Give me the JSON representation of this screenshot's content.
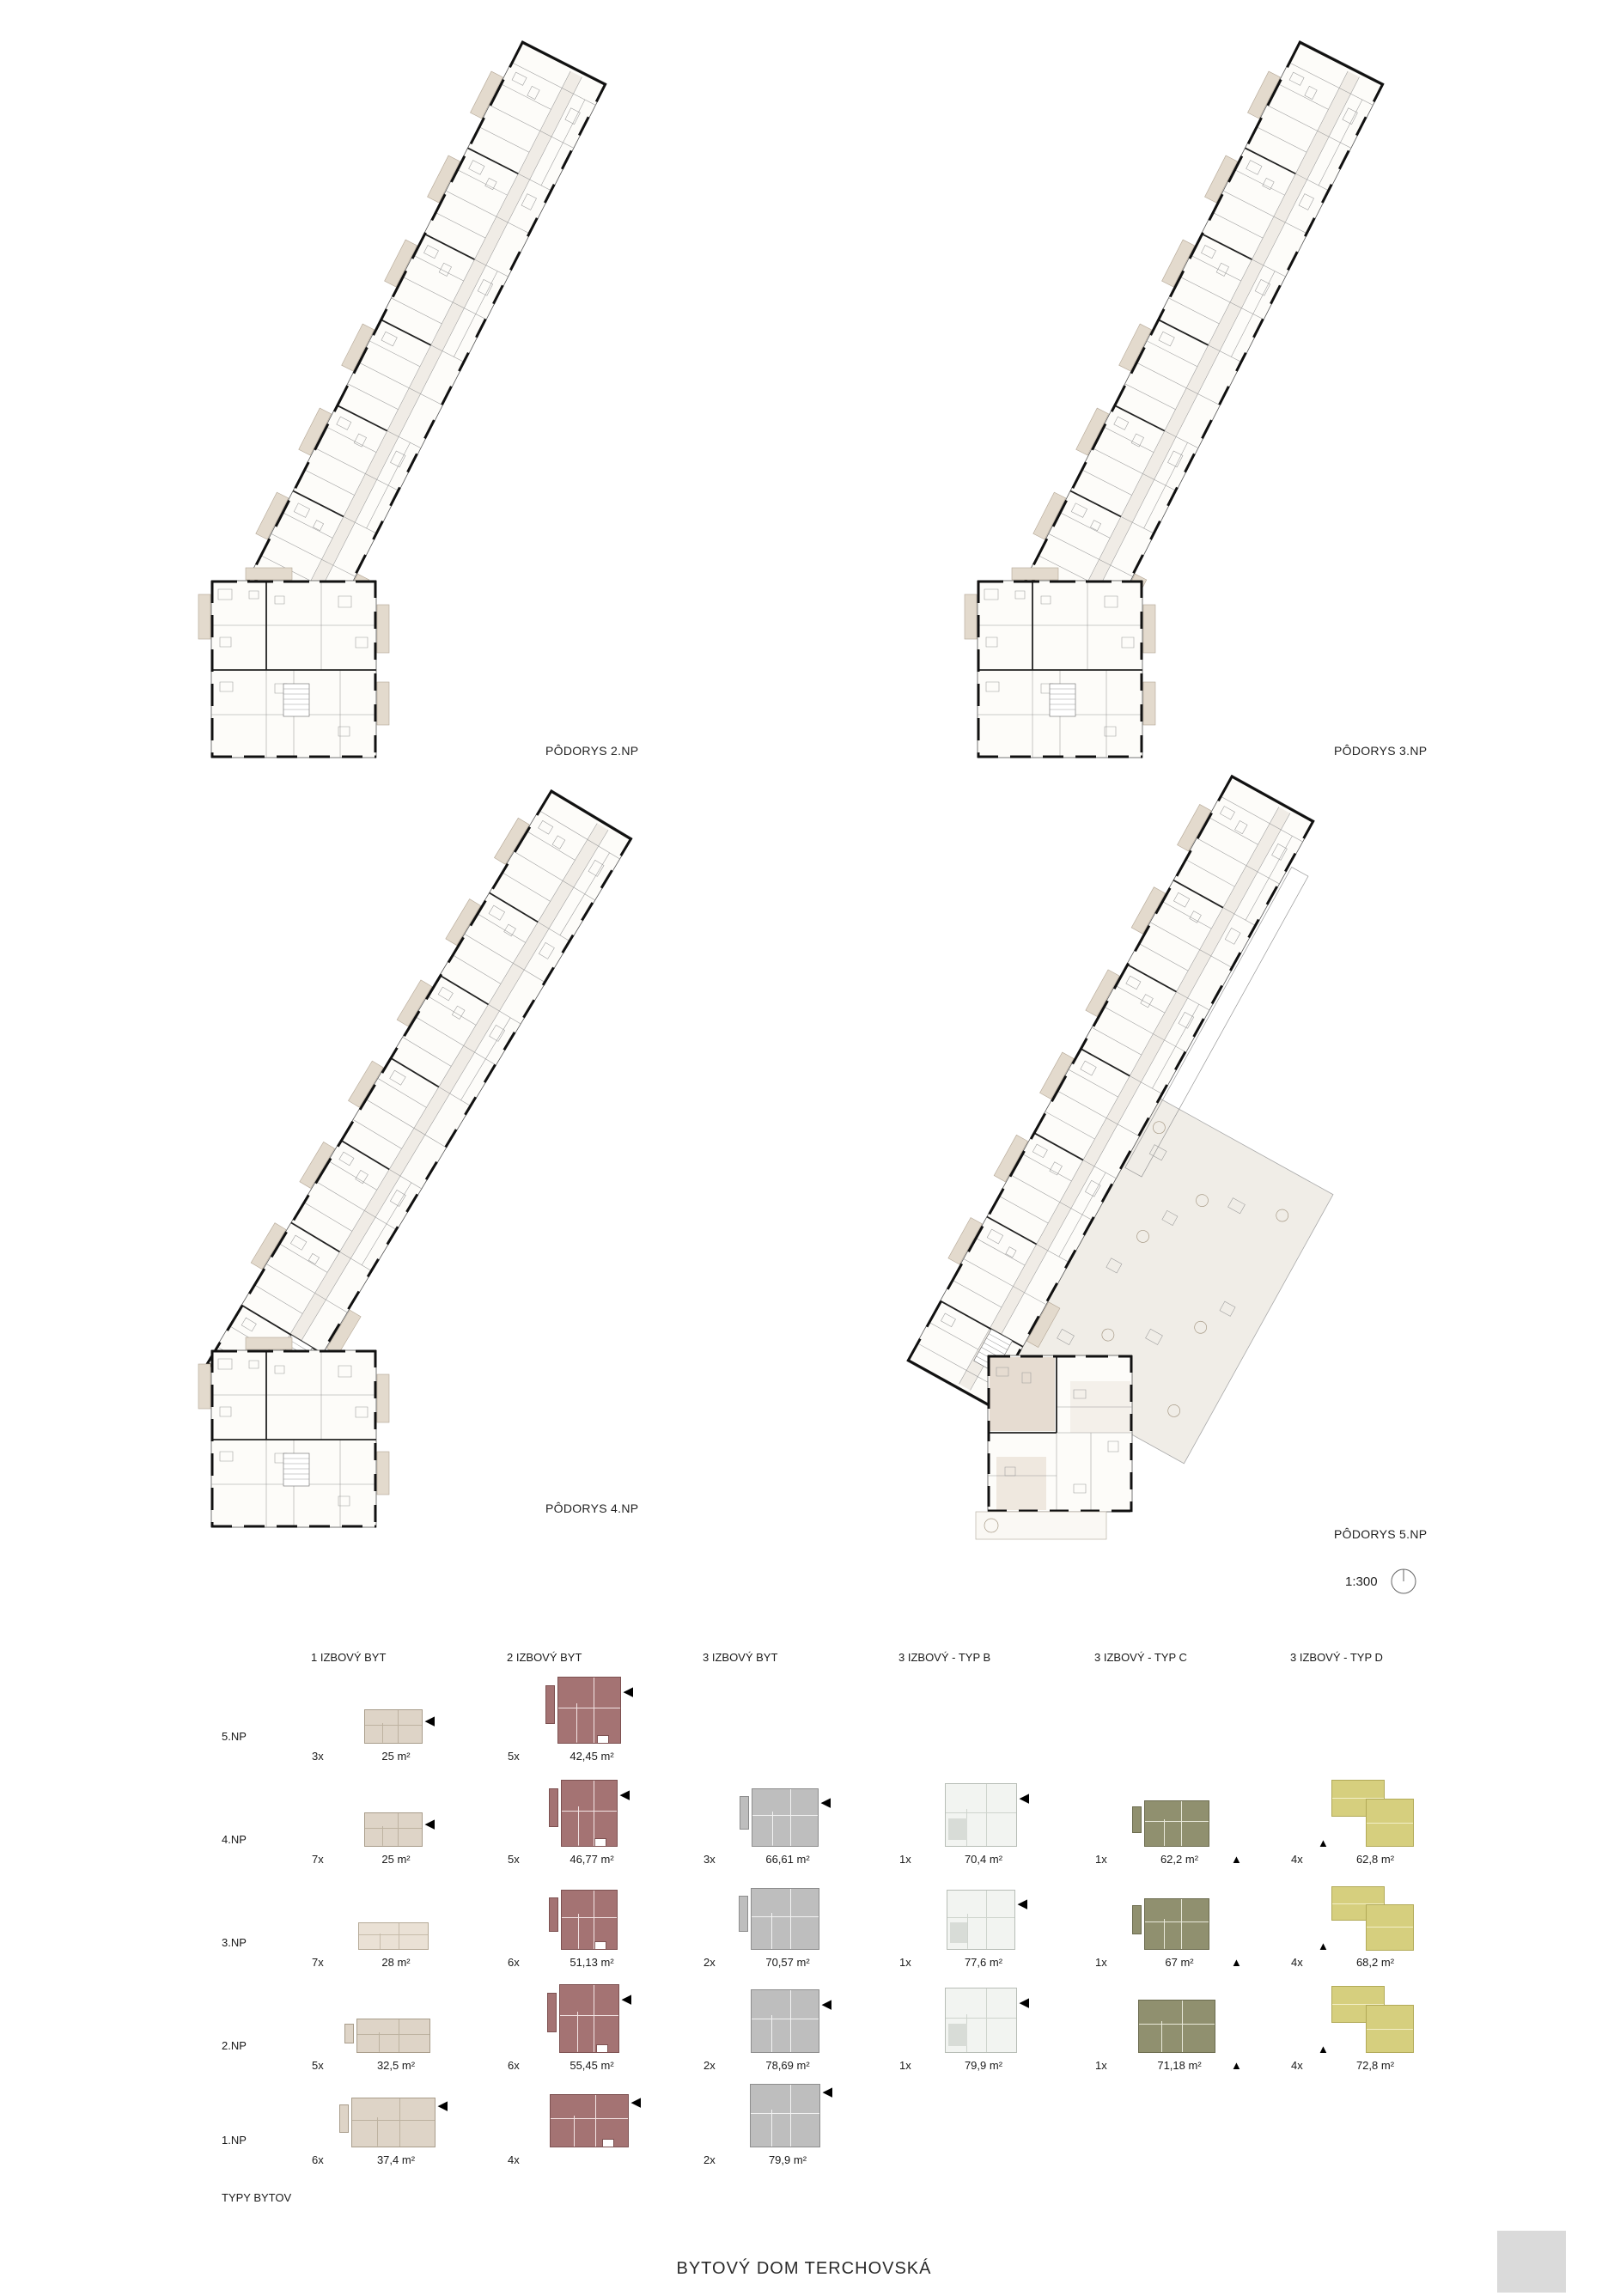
{
  "title": "BYTOVÝ DOM TERCHOVSKÁ",
  "plans": [
    {
      "label": "PÔDORYS 2.NP"
    },
    {
      "label": "PÔDORYS 3.NP"
    },
    {
      "label": "PÔDORYS 4.NP"
    },
    {
      "label": "PÔDORYS 5.NP"
    }
  ],
  "scale": {
    "value": "1:300"
  },
  "icons": {
    "tri_left": "◀",
    "tri_up": "▲"
  },
  "colors": {
    "type1_beige": "#ded4c7",
    "type2_maroon": "#a47373",
    "type3_gray": "#bebebe",
    "typeB_white": "#f2f4f1",
    "typeC_olive": "#90906f",
    "typeD_khaki": "#d6cf7e"
  },
  "legend": {
    "section_label": "TYPY BYTOV",
    "columns": [
      "1 IZBOVÝ BYT",
      "2 IZBOVÝ BYT",
      "3 IZBOVÝ BYT",
      "3 IZBOVÝ - TYP B",
      "3 IZBOVÝ - TYP C",
      "3 IZBOVÝ - TYP D"
    ],
    "rows": [
      {
        "label": "5.NP",
        "cells": [
          {
            "count": "3x",
            "area": "25 m²"
          },
          {
            "count": "5x",
            "area": "42,45 m²"
          },
          null,
          null,
          null,
          null
        ]
      },
      {
        "label": "4.NP",
        "cells": [
          {
            "count": "7x",
            "area": "25 m²"
          },
          {
            "count": "5x",
            "area": "46,77 m²"
          },
          {
            "count": "3x",
            "area": "66,61 m²"
          },
          {
            "count": "1x",
            "area": "70,4 m²"
          },
          {
            "count": "1x",
            "area": "62,2 m²"
          },
          {
            "count": "4x",
            "area": "62,8 m²"
          }
        ]
      },
      {
        "label": "3.NP",
        "cells": [
          {
            "count": "7x",
            "area": "28 m²"
          },
          {
            "count": "6x",
            "area": "51,13 m²"
          },
          {
            "count": "2x",
            "area": "70,57 m²"
          },
          {
            "count": "1x",
            "area": "77,6 m²"
          },
          {
            "count": "1x",
            "area": "67 m²"
          },
          {
            "count": "4x",
            "area": "68,2 m²"
          }
        ]
      },
      {
        "label": "2.NP",
        "cells": [
          {
            "count": "5x",
            "area": "32,5 m²"
          },
          {
            "count": "6x",
            "area": "55,45 m²"
          },
          {
            "count": "2x",
            "area": "78,69 m²"
          },
          {
            "count": "1x",
            "area": "79,9 m²"
          },
          {
            "count": "1x",
            "area": "71,18 m²"
          },
          {
            "count": "4x",
            "area": "72,8 m²"
          }
        ]
      },
      {
        "label": "1.NP",
        "cells": [
          {
            "count": "6x",
            "area": "37,4 m²"
          },
          {
            "count": "4x",
            "area": ""
          },
          {
            "count": "2x",
            "area": "79,9 m²"
          },
          null,
          null,
          null
        ]
      }
    ]
  }
}
